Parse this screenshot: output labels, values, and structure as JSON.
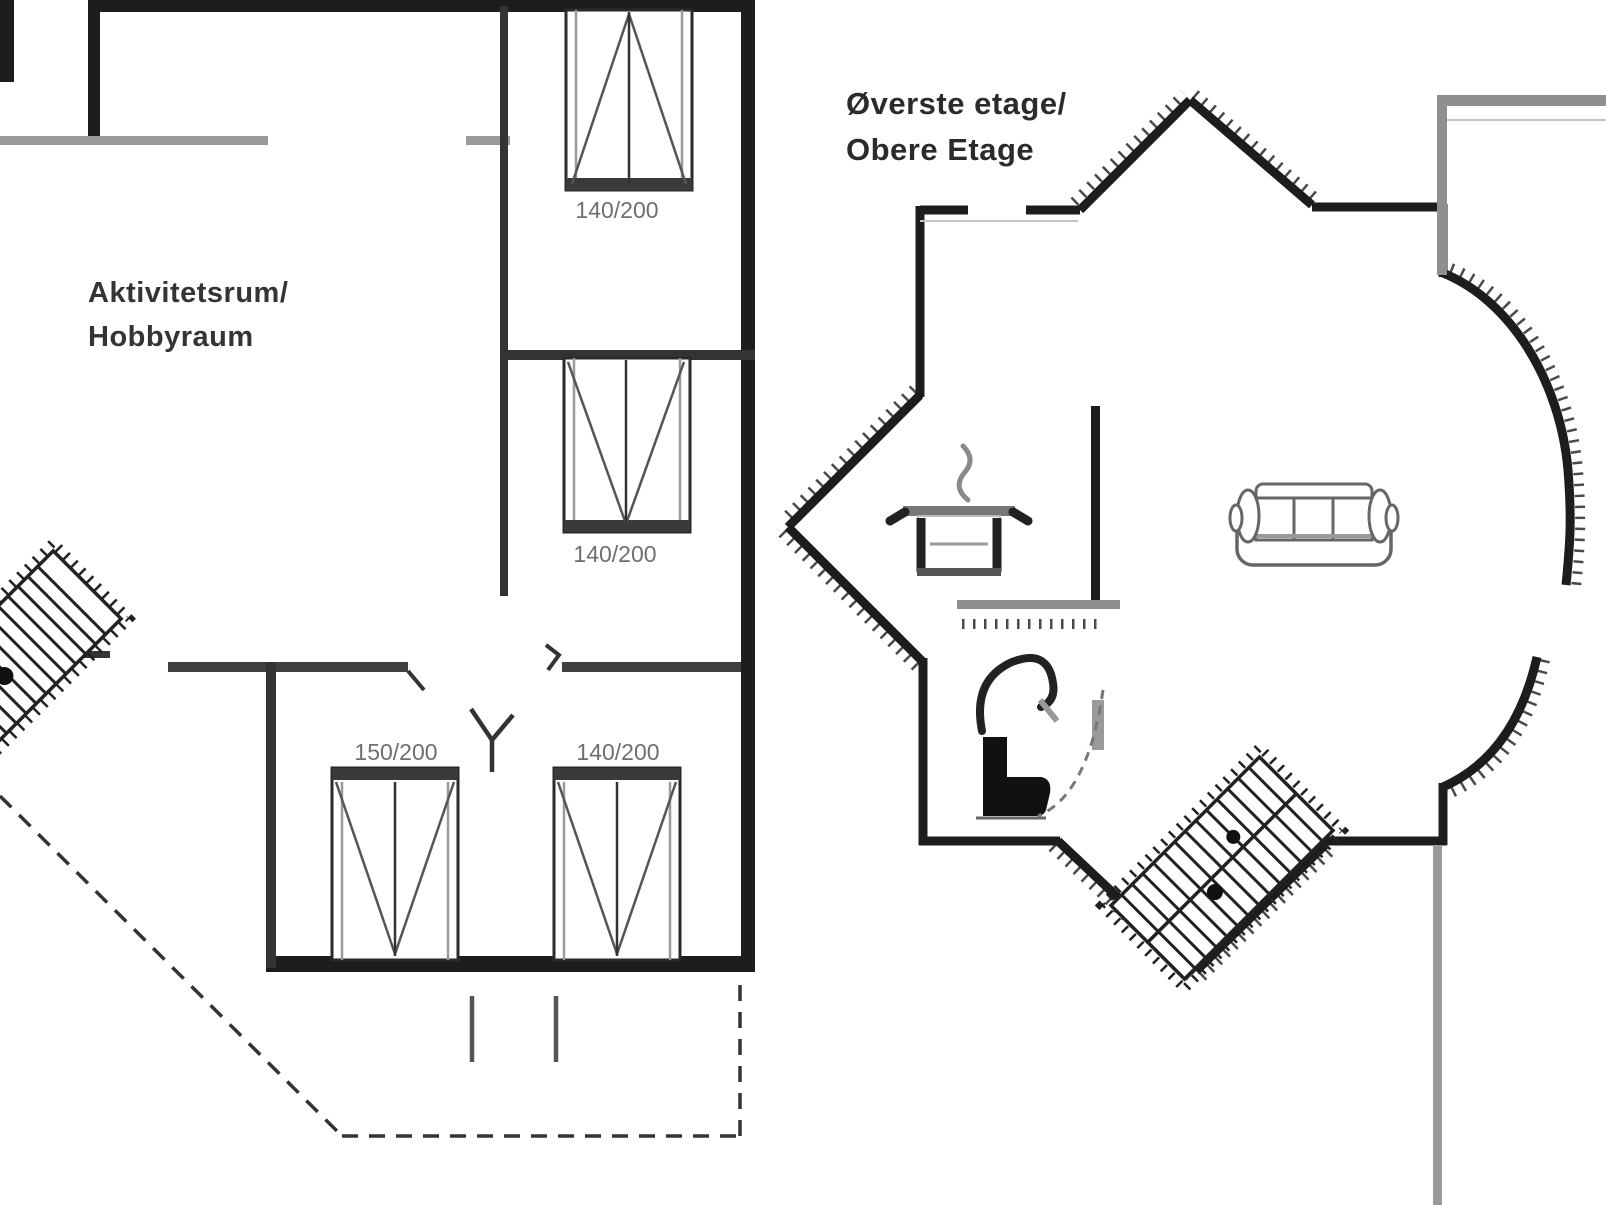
{
  "floor_plan": {
    "upper_floor_label": {
      "line1": "Øverste etage/",
      "line2": "Obere Etage"
    },
    "activity_room_label": {
      "line1": "Aktivitetsrum/",
      "line2": "Hobbyraum"
    },
    "bed_labels": {
      "top_bed": "140/200",
      "middle_bed": "140/200",
      "bottom_left_bed": "150/200",
      "bottom_right_bed": "140/200"
    },
    "icons": {
      "left_staircase": "staircase-icon",
      "right_staircase": "staircase-icon",
      "stove_pot": "cooking-pot-icon",
      "toilet": "toilet-icon",
      "sofa": "sofa-icon",
      "lamp": "wall-lamp-icon"
    },
    "colors": {
      "wall": "#1d1d1d",
      "interior_wall": "#3a3a3a",
      "light_wall": "#9a9a9a",
      "label_text": "#6f6f6f",
      "title_text": "#2b2b2b",
      "background": "#ffffff"
    }
  }
}
